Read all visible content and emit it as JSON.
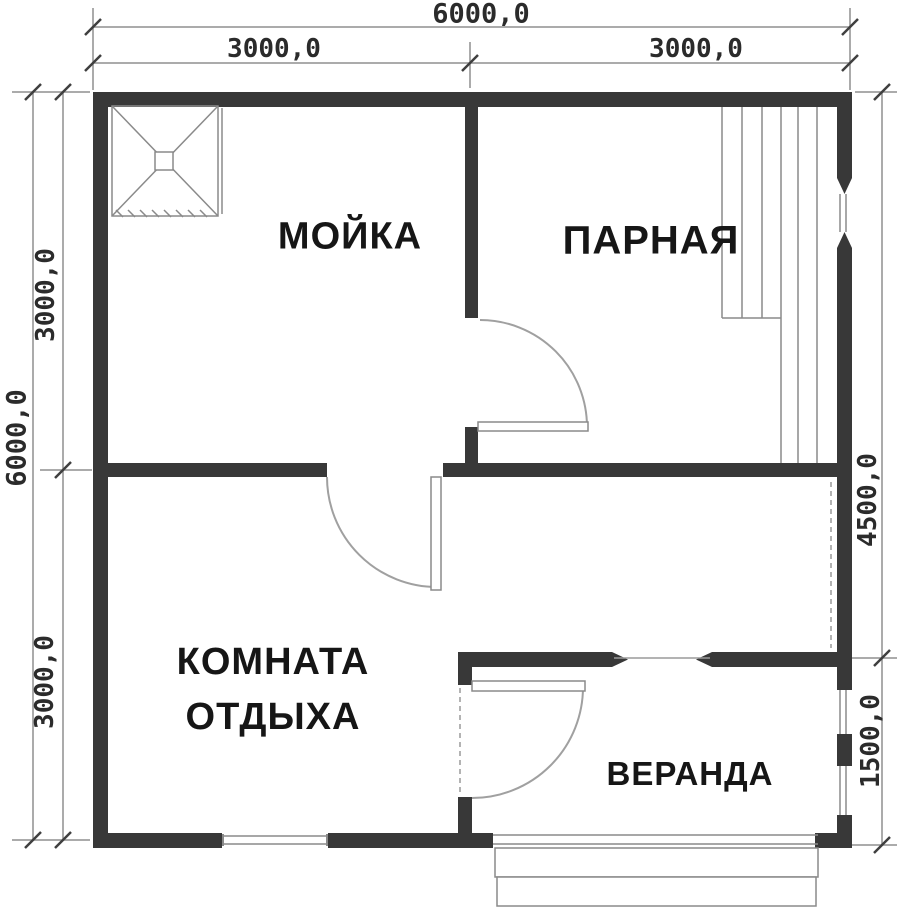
{
  "plan": {
    "title": "Bathhouse floor plan 6000x6000",
    "rooms": {
      "washing": {
        "label": "МОЙКА"
      },
      "steam": {
        "label": "ПАРНАЯ"
      },
      "rest": {
        "label_line1": "КОМНАТА",
        "label_line2": "ОТДЫХА"
      },
      "veranda": {
        "label": "ВЕРАНДА"
      }
    },
    "dimensions": {
      "top_total": "6000,0",
      "top_left": "3000,0",
      "top_right": "3000,0",
      "left_total": "6000,0",
      "left_upper": "3000,0",
      "left_lower": "3000,0",
      "right_upper": "4500,0",
      "right_lower": "1500,0"
    },
    "colors": {
      "wall": "#383838",
      "thin_line": "#8a8a8a",
      "text": "#161616"
    }
  }
}
